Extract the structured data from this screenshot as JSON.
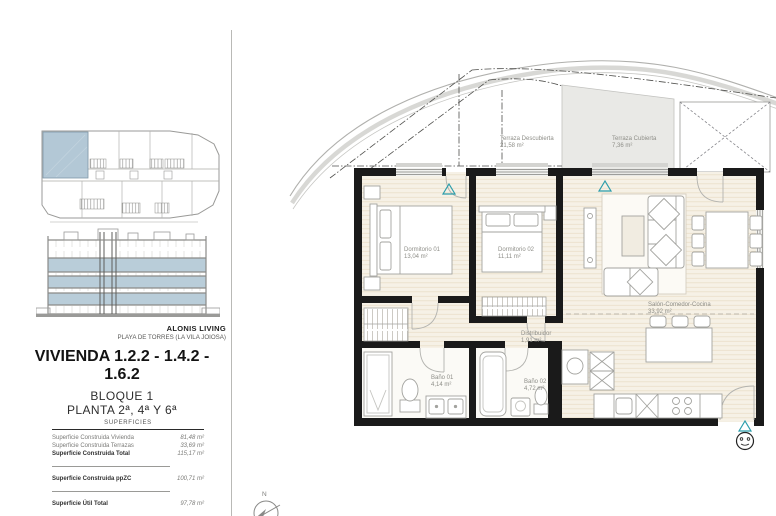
{
  "brand": {
    "name": "ALONIS LIVING",
    "location": "PLAYA DE TORRES (LA VILA JOIOSA)"
  },
  "unit": {
    "title": "VIVIENDA 1.2.2 - 1.4.2 - 1.6.2",
    "block": "BLOQUE 1",
    "floors": "PLANTA 2ª, 4ª Y 6ª"
  },
  "surfaces": {
    "header": "SUPERFICIES",
    "rows": [
      {
        "label": "Superficie Construida Vivienda",
        "value": "81,48 m²"
      },
      {
        "label": "Superficie Construida Terrazas",
        "value": "33,69 m²"
      },
      {
        "label": "Superficie Construida Total",
        "value": "115,17 m²"
      },
      {
        "label": "Superficie Construida ppZC",
        "value": "100,71 m²"
      },
      {
        "label": "Superficie Útil Total",
        "value": "97,78 m²"
      }
    ]
  },
  "plan": {
    "compass": "N",
    "rooms": {
      "terraza_descubierta": {
        "name": "Terraza Descubierta",
        "area": "21,58 m²"
      },
      "terraza_cubierta": {
        "name": "Terraza Cubierta",
        "area": "7,36 m²"
      },
      "dormitorio1": {
        "name": "Dormitorio 01",
        "area": "13,04 m²"
      },
      "dormitorio2": {
        "name": "Dormitorio 02",
        "area": "11,11 m²"
      },
      "salon": {
        "name": "Salón-Comedor-Cocina",
        "area": "33,92 m²"
      },
      "distribuidor": {
        "name": "Distribuidor",
        "area": "1,91 m²"
      },
      "bano1": {
        "name": "Baño 01",
        "area": "4,14 m²"
      },
      "bano2": {
        "name": "Baño 02",
        "area": "4,72 m²"
      }
    }
  },
  "colors": {
    "highlight_blue": "#b3c8d6",
    "elevation_blue": "#b9cdd9",
    "marker_teal": "#2b9dab",
    "wall_black": "#1a1a1a"
  }
}
